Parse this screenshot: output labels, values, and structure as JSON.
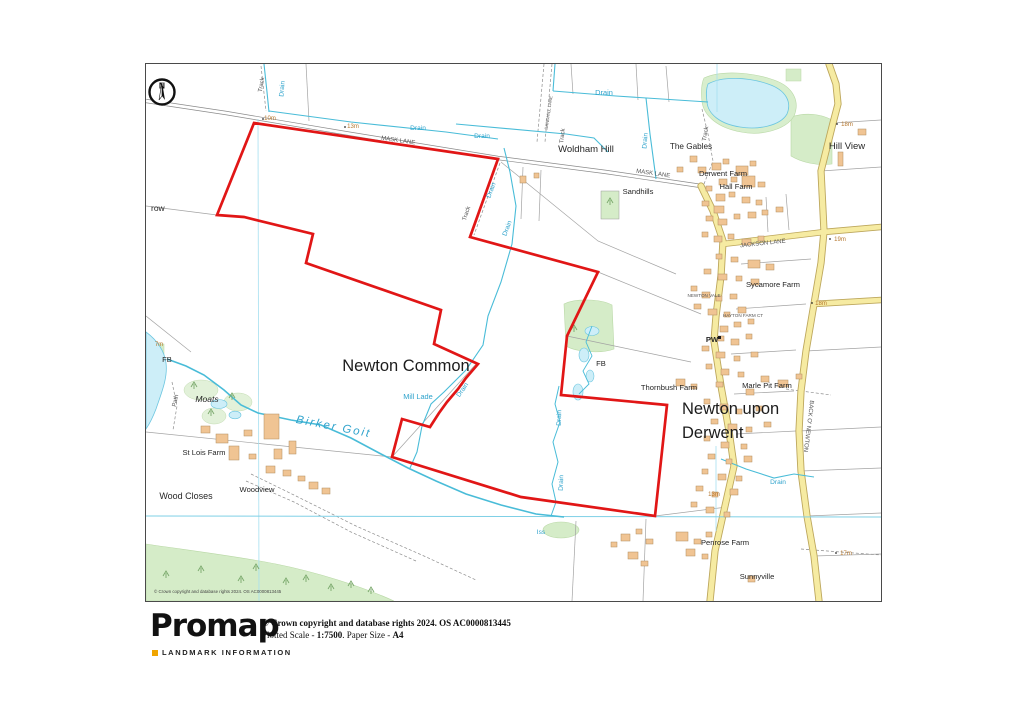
{
  "page": {
    "background": "#ffffff"
  },
  "map": {
    "accent_color": "#e11616",
    "north_label": "N",
    "copyright_note": "© Crown copyright and database rights 2024. OS AC0000813445",
    "settlements": [
      {
        "text": "Newton Common"
      },
      {
        "text": "Newton upon"
      },
      {
        "text": "Derwent"
      }
    ],
    "places": [
      {
        "text": "Woldham Hill"
      },
      {
        "text": "The Gables"
      },
      {
        "text": "Hill View"
      },
      {
        "text": "Derwent Farm"
      },
      {
        "text": "Hall Farm"
      },
      {
        "text": "Sandhills"
      },
      {
        "text": "Sycamore Farm"
      },
      {
        "text": "PW"
      },
      {
        "text": "FB"
      },
      {
        "text": "Thornbush Farm"
      },
      {
        "text": "Marle Pit Farm"
      },
      {
        "text": "St Lois Farm"
      },
      {
        "text": "Woodview"
      },
      {
        "text": "Wood Closes"
      },
      {
        "text": "Penrose Farm"
      },
      {
        "text": "Sunnyville"
      },
      {
        "text": "Moats"
      },
      {
        "text": "row"
      },
      {
        "text": "FB"
      }
    ],
    "roads": [
      {
        "text": "MASK LANE"
      },
      {
        "text": "MASK LANE"
      },
      {
        "text": "JACKSON LANE"
      },
      {
        "text": "BACK O' NEWTON"
      },
      {
        "text": "NEWTON VALE"
      },
      {
        "text": "HAYTON FARM CT"
      },
      {
        "text": "SANDHILL LANE"
      },
      {
        "text": "Track"
      },
      {
        "text": "Track"
      },
      {
        "text": "Track"
      },
      {
        "text": "Track"
      },
      {
        "text": "Path"
      }
    ],
    "water": [
      {
        "text": "Drain"
      },
      {
        "text": "Drain"
      },
      {
        "text": "Drain"
      },
      {
        "text": "Drain"
      },
      {
        "text": "Drain"
      },
      {
        "text": "Drain"
      },
      {
        "text": "Drain"
      },
      {
        "text": "Drain"
      },
      {
        "text": "Drain"
      },
      {
        "text": "Drain"
      },
      {
        "text": "Drain"
      },
      {
        "text": "Mill Lade"
      },
      {
        "text": "Birker  Goit"
      },
      {
        "text": "Iss"
      }
    ],
    "heights": [
      {
        "text": "10m"
      },
      {
        "text": "13m"
      },
      {
        "text": "18m"
      },
      {
        "text": "19m"
      },
      {
        "text": "18m"
      },
      {
        "text": "13m"
      },
      {
        "text": "17m"
      },
      {
        "text": "7m"
      }
    ]
  },
  "footer": {
    "brand": "Promap",
    "brand_sub": "LANDMARK INFORMATION",
    "line1": "© Crown copyright and database rights 2024. OS AC0000813445",
    "line2_parts": {
      "a": "Plotted Scale - ",
      "b": "1:7500",
      "c": ".  Paper Size - ",
      "d": "A4"
    }
  }
}
